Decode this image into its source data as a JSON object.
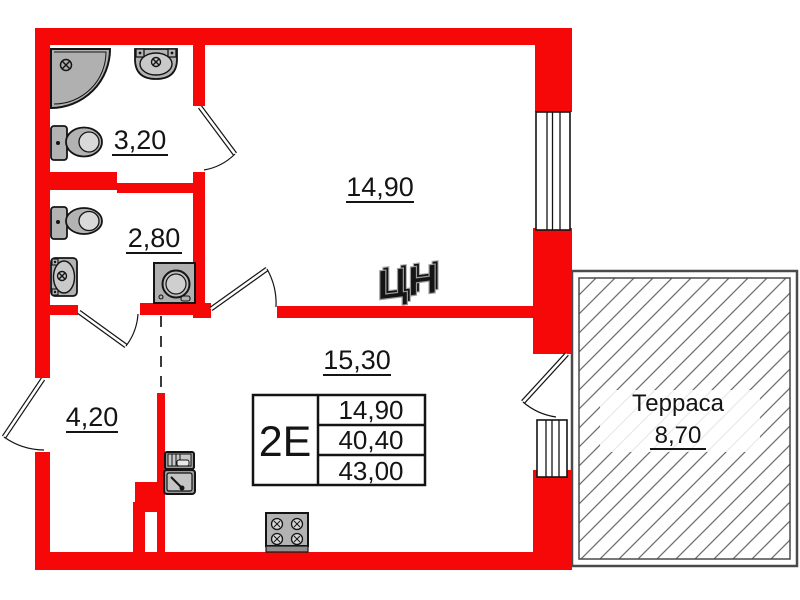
{
  "plan_title": "apartment-floor-plan",
  "colors": {
    "wall_red": "#f60808",
    "outline_black": "#141414",
    "fixture_gray": "#b3b3b3",
    "fixture_light": "#c9c9c9",
    "terrace_border": "#4a4a4a",
    "hatch_gray": "#6e6e6e",
    "watermark_gray": "#9a9a9a"
  },
  "rooms": {
    "bathroom": {
      "area": "3,20"
    },
    "wc": {
      "area": "2,80"
    },
    "bedroom": {
      "area": "14,90"
    },
    "kitchen_living": {
      "area": "15,30"
    },
    "hallway": {
      "area": "4,20"
    },
    "terrace": {
      "name": "Терраса",
      "area": "8,70"
    }
  },
  "info_table": {
    "type": "2Е",
    "rows": [
      "14,90",
      "40,40",
      "43,00"
    ]
  },
  "watermark": "ЦН",
  "icons": [
    "shower-icon",
    "sink-icon",
    "toilet-icon",
    "toilet-icon",
    "washing-machine-icon",
    "kitchen-sink-icon",
    "stove-icon",
    "door-swing-icon",
    "window-icon"
  ]
}
